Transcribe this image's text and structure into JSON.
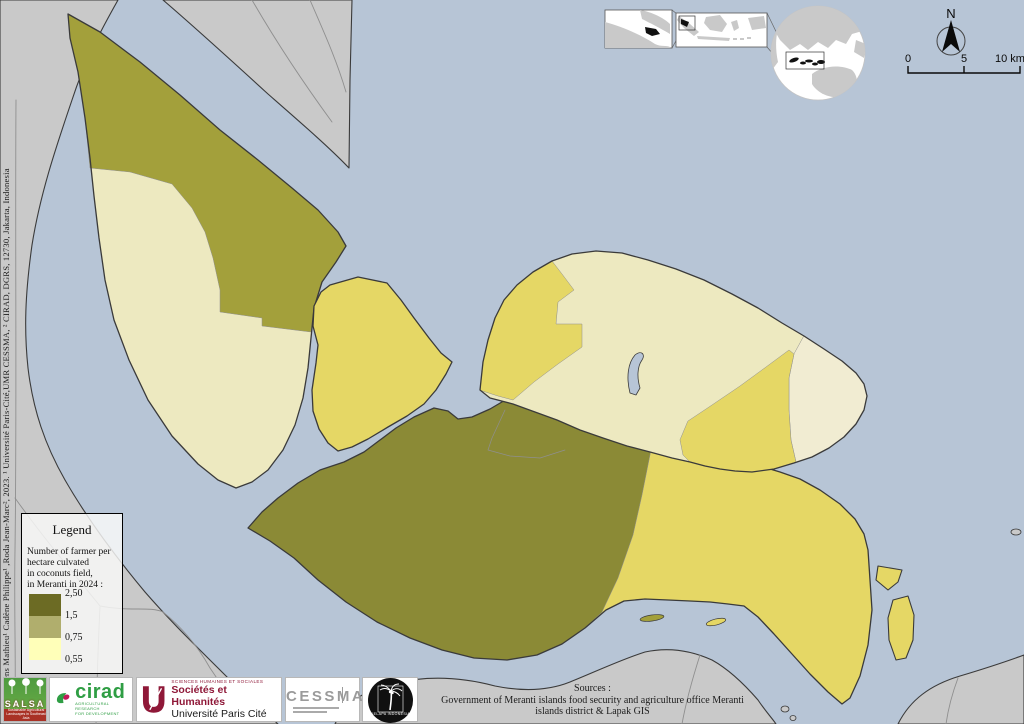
{
  "colors": {
    "water": "#b7c5d6",
    "land_gray": "#c9c9c9",
    "coastline": "#3a3a3a",
    "boundary_gray": "#8f8f8f",
    "class_high": "#8b8a36",
    "class_midhigh": "#a3a03b",
    "class_mid": "#e5d765",
    "class_low": "#ece4ac",
    "class_lower": "#ede9c0",
    "class_lowest": "#f1ecd2",
    "legend_swatch_high": "#6c6b24",
    "legend_swatch_mid": "#b0ae6d",
    "legend_swatch_low": "#ffffb9",
    "inset_black": "#111111"
  },
  "legend": {
    "title": "Legend",
    "description": "Number of farmer per\nhectare culvated\nin coconuts field,\nin Meranti in 2024 :",
    "values": [
      "2,50",
      "1,5",
      "0,75",
      "0,55"
    ]
  },
  "north": {
    "label": "N"
  },
  "scalebar": {
    "labels": [
      "0",
      "5",
      "10 km"
    ]
  },
  "sources": {
    "title": "Sources :",
    "body": "Government of Meranti islands food security and agriculture office Meranti\nislands district & Lapak GIS"
  },
  "citation": "Bufkens Mathieu¹ Cadène Philippe¹ ,Roda Jean-Marc², 2023. ¹ Université Paris-Cité,UMR CESSMA, ² CIRAD, DGRS, 12730, Jakarta, Indonesia",
  "logos": {
    "salsa": {
      "name": "SALSA",
      "subtitle": "Sustainable Agricultural Landscapes in Southeast Asia"
    },
    "cirad": {
      "name": "cirad",
      "subtitle": "AGRICULTURAL RESEARCH\nFOR DEVELOPMENT"
    },
    "upc": {
      "line1": "SCIENCES HUMAINES ET SOCIALES",
      "line2": "Sociétés et Humanités",
      "line3": "Université Paris Cité"
    },
    "cessma": {
      "name": "CESSMA"
    },
    "kelapa": {
      "name": "KELAPA INDONESIA"
    }
  }
}
